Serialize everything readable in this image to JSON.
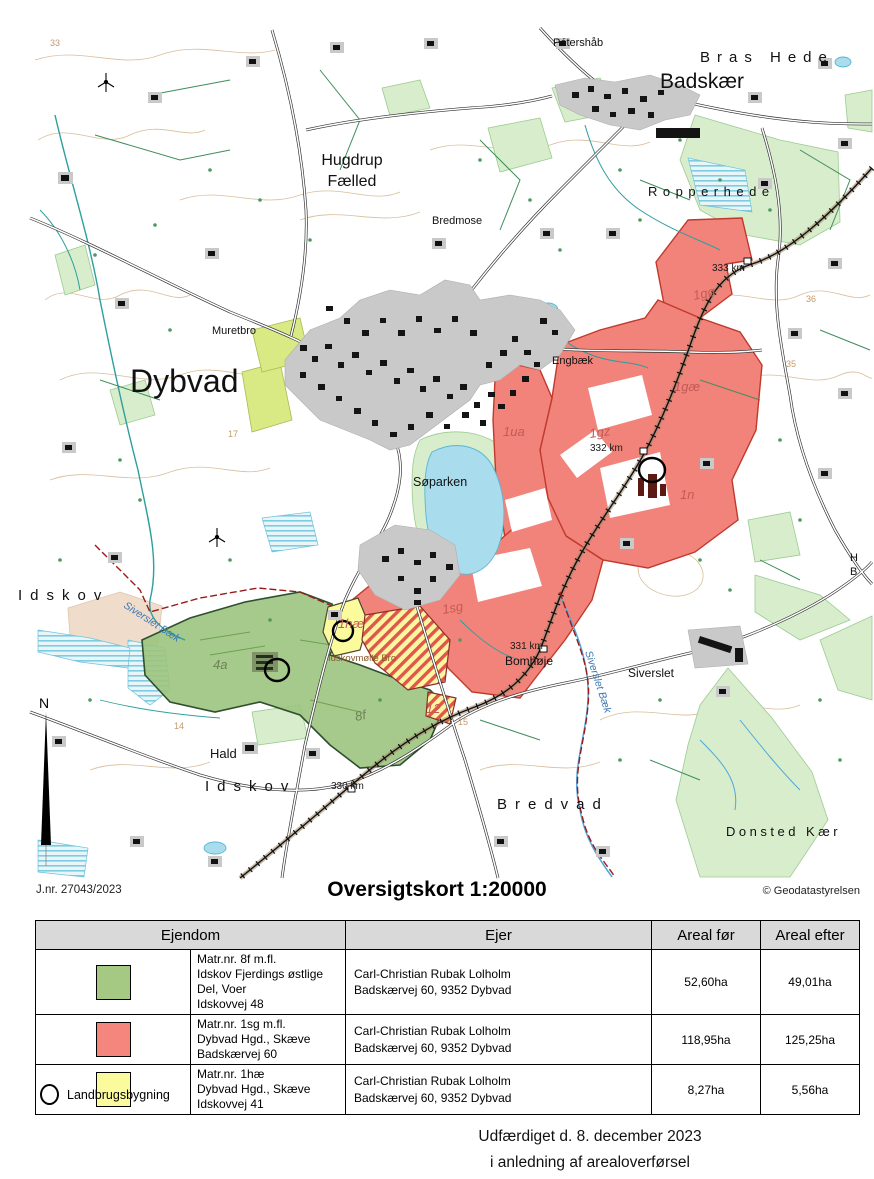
{
  "page": {
    "jnr": "J.nr. 27043/2023",
    "title": "Oversigtskort 1:20000",
    "copyright": "© Geodatastyrelsen",
    "footer_line1": "Udfærdiget d. 8. december 2023",
    "footer_line2": "i anledning af arealoverførsel"
  },
  "legend": {
    "label": "Landbrugsbygning"
  },
  "table": {
    "headers": [
      "Ejendom",
      "Ejer",
      "Areal før",
      "Areal efter"
    ],
    "rows": [
      {
        "swatch_color": "#A5C882",
        "matr": "Matr.nr. 8f m.fl.",
        "ejerlav": "Idskov Fjerdings østlige Del, Voer",
        "adresse": "Idskovvej 48",
        "ejer_navn": "Carl-Christian Rubak Lolholm",
        "ejer_adresse": "Badskærvej 60, 9352 Dybvad",
        "areal_foer": "52,60ha",
        "areal_efter": "49,01ha"
      },
      {
        "swatch_color": "#F4867E",
        "matr": "Matr.nr. 1sg m.fl.",
        "ejerlav": "Dybvad Hgd., Skæve",
        "adresse": "Badskærvej 60",
        "ejer_navn": "Carl-Christian Rubak Lolholm",
        "ejer_adresse": "Badskærvej 60, 9352 Dybvad",
        "areal_foer": "118,95ha",
        "areal_efter": "125,25ha"
      },
      {
        "swatch_color": "#FBFB9E",
        "matr": "Matr.nr. 1hæ",
        "ejerlav": "Dybvad Hgd., Skæve",
        "adresse": "Idskovvej 41",
        "ejer_navn": "Carl-Christian Rubak Lolholm",
        "ejer_adresse": "Badskærvej 60, 9352 Dybvad",
        "areal_foer": "8,27ha",
        "areal_efter": "5,56ha"
      }
    ]
  },
  "map": {
    "north_label": "N",
    "place_labels": [
      "Pétershåb",
      "Bras Hede",
      "Badskær",
      "Ropperhede",
      "Hugdrup",
      "Fælled",
      "Bredmose",
      "Muretbro",
      "Dybvad",
      "Engbæk",
      "Søparken",
      "Idskov",
      "Idskovmølle Bro",
      "Bomhøje",
      "Siverslet",
      "Hald",
      "Idskov",
      "Bredvad",
      "Donsted Kær",
      "H",
      "B"
    ],
    "stream_labels": [
      "Siverslet Bæk",
      "Siverslet Bæk"
    ],
    "parcel_labels": [
      "1ua",
      "1gz",
      "1gø",
      "1gæ",
      "1n",
      "1sg",
      "4a",
      "8f",
      "1hæ",
      "12"
    ],
    "km_labels": [
      "333 km",
      "332 km",
      "331 km",
      "330 km"
    ],
    "contour_labels": [
      "33",
      "17",
      "14",
      "15",
      "35",
      "36"
    ],
    "colors": {
      "parcel_green": "#A5C882",
      "parcel_red": "#F2837B",
      "parcel_yellow": "#FBFB9E",
      "woodland": "#D8EDCB",
      "water": "#A9DCEC",
      "contour": "#D9BD9B",
      "boundary_red": "#9B1B1B"
    }
  }
}
